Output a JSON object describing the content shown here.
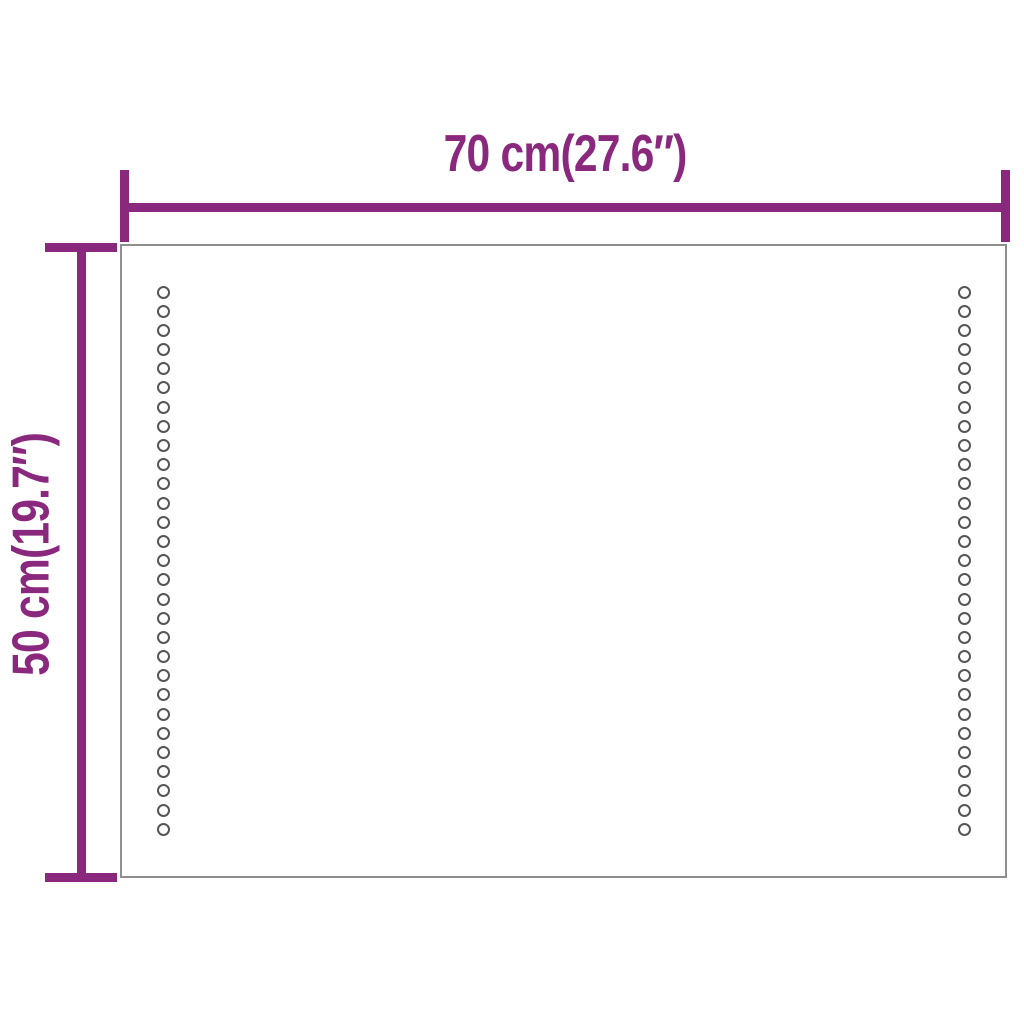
{
  "diagram": {
    "type": "product-dimension-diagram",
    "product": "rectangular LED mirror outline"
  },
  "dimensions": {
    "width": {
      "label": "70 cm(27.6″)",
      "value_cm": "70 cm",
      "value_inches": "27.6″"
    },
    "height": {
      "label": "50 cm(19.7″)",
      "value_cm": "50 cm",
      "value_inches": "19.7″"
    }
  },
  "mirror": {
    "led_columns": [
      "left",
      "right"
    ],
    "leds_per_column": 29
  },
  "colors": {
    "dimension_line": "#8A287D",
    "mirror_border": "#8F8F8F",
    "led_ring": "#565656",
    "background": "#FFFFFF"
  }
}
